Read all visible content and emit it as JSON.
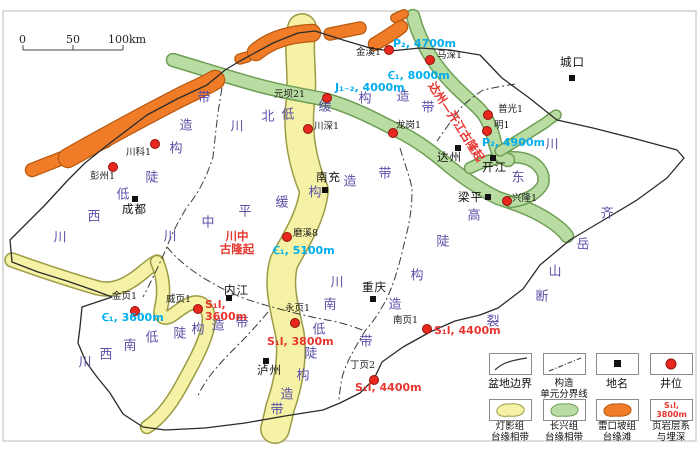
{
  "colors": {
    "cyan": "#00AEEF",
    "red": "#E8352E",
    "purple": "#5B50A8",
    "yellow_fill": "#f5f1a5",
    "yellow_edge": "#9b9b46",
    "green_fill": "#b9dca3",
    "green_edge": "#6f9e55",
    "orange_fill": "#f07c28",
    "orange_edge": "#b85a10",
    "well_dot": "#E8281E"
  },
  "scalebar": {
    "labels": [
      "0",
      "50",
      "100km"
    ]
  },
  "map": {
    "zone_phrases": [
      {
        "name": "chuanxi-low-steep-belt",
        "text": "川西低陡构造带",
        "chars": [
          [
            "川",
            60,
            238
          ],
          [
            "西",
            94,
            217
          ],
          [
            "低",
            123,
            195
          ],
          [
            "陡",
            152,
            178
          ],
          [
            "构",
            176,
            149
          ],
          [
            "造",
            186,
            126
          ],
          [
            "带",
            204,
            98
          ]
        ]
      },
      {
        "name": "chuanbei-low-gentle-belt",
        "text": "川北低缓构造带",
        "chars": [
          [
            "川",
            237,
            127
          ],
          [
            "北",
            268,
            117
          ],
          [
            "低",
            288,
            115
          ],
          [
            "缓",
            325,
            107
          ],
          [
            "构",
            365,
            99
          ],
          [
            "造",
            403,
            97
          ],
          [
            "带",
            428,
            108
          ]
        ]
      },
      {
        "name": "chuanzhong-flat-gentle-belt",
        "text": "川中平缓构造带",
        "chars": [
          [
            "川",
            170,
            237
          ],
          [
            "中",
            208,
            223
          ],
          [
            "平",
            245,
            212
          ],
          [
            "缓",
            282,
            203
          ],
          [
            "构",
            315,
            193
          ],
          [
            "造",
            350,
            182
          ],
          [
            "带",
            385,
            174
          ]
        ]
      },
      {
        "name": "chuandong-high-steep-belt",
        "text": "川东高陡构造带",
        "chars": [
          [
            "川",
            552,
            145
          ],
          [
            "东",
            518,
            178
          ],
          [
            "高",
            474,
            216
          ],
          [
            "陡",
            443,
            242
          ],
          [
            "构",
            417,
            276
          ],
          [
            "造",
            395,
            305
          ],
          [
            "带",
            366,
            342
          ]
        ]
      },
      {
        "name": "chuannan-low-steep-belt",
        "text": "川南低陡构造带",
        "chars": [
          [
            "川",
            337,
            283
          ],
          [
            "南",
            330,
            305
          ],
          [
            "低",
            319,
            330
          ],
          [
            "陡",
            311,
            354
          ],
          [
            "构",
            303,
            376
          ],
          [
            "造",
            287,
            395
          ],
          [
            "带",
            277,
            410
          ]
        ]
      },
      {
        "name": "chuanxinan-low-steep-belt",
        "text": "川西南低陡构造带",
        "chars": [
          [
            "川",
            85,
            363
          ],
          [
            "西",
            106,
            355
          ],
          [
            "南",
            130,
            346
          ],
          [
            "低",
            152,
            338
          ],
          [
            "陡",
            180,
            334
          ],
          [
            "构",
            198,
            330
          ],
          [
            "造",
            218,
            326
          ],
          [
            "带",
            242,
            323
          ]
        ]
      },
      {
        "name": "qiyueshan-fault",
        "text": "齐岳山断裂",
        "chars": [
          [
            "齐",
            607,
            214
          ],
          [
            "岳",
            583,
            245
          ],
          [
            "山",
            555,
            272
          ],
          [
            "断",
            542,
            297
          ],
          [
            "裂",
            493,
            322
          ]
        ]
      }
    ],
    "red_labels": [
      {
        "name": "chuanzhong-paleo-uplift",
        "lines": [
          "川中",
          "古隆起"
        ],
        "x": 237,
        "y": 243,
        "rotate": 0
      },
      {
        "name": "dazhou-kaijiang-paleo-uplift",
        "lines": [
          "达州—开江古隆起"
        ],
        "x": 456,
        "y": 122,
        "rotate": 57
      }
    ],
    "cities": [
      {
        "name": "城口",
        "sx": 572,
        "sy": 78,
        "lx": 560,
        "ly": 56
      },
      {
        "name": "成都",
        "sx": 135,
        "sy": 199,
        "lx": 122,
        "ly": 203
      },
      {
        "name": "南充",
        "sx": 325,
        "sy": 190,
        "lx": 316,
        "ly": 171
      },
      {
        "name": "达州",
        "sx": 458,
        "sy": 148,
        "lx": 437,
        "ly": 151
      },
      {
        "name": "开江",
        "sx": 493,
        "sy": 158,
        "lx": 482,
        "ly": 161
      },
      {
        "name": "梁平",
        "sx": 488,
        "sy": 197,
        "lx": 458,
        "ly": 191
      },
      {
        "name": "内江",
        "sx": 229,
        "sy": 298,
        "lx": 224,
        "ly": 284
      },
      {
        "name": "泸州",
        "sx": 266,
        "sy": 361,
        "lx": 257,
        "ly": 364
      },
      {
        "name": "重庆",
        "sx": 373,
        "sy": 299,
        "lx": 362,
        "ly": 281
      }
    ],
    "wells": [
      {
        "name": "川科1",
        "x": 155,
        "y": 144,
        "lx": 126,
        "ly": 148
      },
      {
        "name": "彭州1",
        "x": 113,
        "y": 167,
        "lx": 90,
        "ly": 172
      },
      {
        "name": "金溪1",
        "x": 389,
        "y": 50,
        "lx": 356,
        "ly": 48
      },
      {
        "name": "马深1",
        "x": 430,
        "y": 60,
        "lx": 437,
        "ly": 51
      },
      {
        "name": "元坝21",
        "x": 327,
        "y": 98,
        "lx": 274,
        "ly": 90
      },
      {
        "name": "川深1",
        "x": 308,
        "y": 129,
        "lx": 314,
        "ly": 122
      },
      {
        "name": "龙岗1",
        "x": 393,
        "y": 133,
        "lx": 396,
        "ly": 121
      },
      {
        "name": "普光1",
        "x": 488,
        "y": 115,
        "lx": 498,
        "ly": 105
      },
      {
        "name": "明1",
        "x": 487,
        "y": 131,
        "lx": 494,
        "ly": 121
      },
      {
        "name": "兴隆1",
        "x": 507,
        "y": 201,
        "lx": 512,
        "ly": 194
      },
      {
        "name": "磨溪8",
        "x": 287,
        "y": 237,
        "lx": 293,
        "ly": 229
      },
      {
        "name": "金页1",
        "x": 135,
        "y": 311,
        "lx": 112,
        "ly": 292
      },
      {
        "name": "威页1",
        "x": 198,
        "y": 309,
        "lx": 166,
        "ly": 295
      },
      {
        "name": "永页1",
        "x": 295,
        "y": 323,
        "lx": 285,
        "ly": 304
      },
      {
        "name": "南页1",
        "x": 427,
        "y": 329,
        "lx": 393,
        "ly": 316
      },
      {
        "name": "丁页2",
        "x": 374,
        "y": 380,
        "lx": 350,
        "ly": 361
      }
    ],
    "depth_labels": [
      {
        "lines": [
          "P₂, 4700m"
        ],
        "x": 393,
        "y": 38,
        "color": "cyan"
      },
      {
        "lines": [
          "Ꞓ₁, 8000m"
        ],
        "x": 388,
        "y": 70,
        "color": "cyan"
      },
      {
        "lines": [
          "J₁₋₂, 4000m"
        ],
        "x": 335,
        "y": 82,
        "color": "cyan"
      },
      {
        "lines": [
          "P₂, 4900m"
        ],
        "x": 482,
        "y": 137,
        "color": "cyan"
      },
      {
        "lines": [
          "Ꞓ₁, 5100m"
        ],
        "x": 273,
        "y": 245,
        "color": "cyan"
      },
      {
        "lines": [
          "Ꞓ₁, 3600m"
        ],
        "x": 102,
        "y": 312,
        "color": "cyan"
      },
      {
        "lines": [
          "S₁l,",
          "3600m"
        ],
        "x": 205,
        "y": 299,
        "color": "red"
      },
      {
        "lines": [
          "S₁l, 3800m"
        ],
        "x": 267,
        "y": 336,
        "color": "red"
      },
      {
        "lines": [
          "S₁l, 4400m"
        ],
        "x": 434,
        "y": 325,
        "color": "red"
      },
      {
        "lines": [
          "S₁l, 4400m"
        ],
        "x": 355,
        "y": 382,
        "color": "red"
      }
    ]
  },
  "legend": {
    "cols_x": [
      489,
      543,
      596,
      650
    ],
    "row_box_y": [
      353,
      399
    ],
    "row_label_y": [
      378,
      421
    ],
    "row1": [
      {
        "name": "basin-boundary",
        "symbol": "curve",
        "label_lines": [
          "盆地边界"
        ]
      },
      {
        "name": "unit-boundary",
        "symbol": "dashdot",
        "label_lines": [
          "构造",
          "单元分界线"
        ]
      },
      {
        "name": "place-name",
        "symbol": "square",
        "label_lines": [
          "地名"
        ]
      },
      {
        "name": "well-location",
        "symbol": "dot",
        "label_lines": [
          "井位"
        ]
      }
    ],
    "row2": [
      {
        "name": "dengying-platform-margin",
        "symbol": "yellow-blob",
        "label_lines": [
          "灯影组",
          "台缘相带"
        ]
      },
      {
        "name": "changxing-platform-margin",
        "symbol": "green-blob",
        "label_lines": [
          "长兴组",
          "台缘相带"
        ]
      },
      {
        "name": "leikoupo-margin-shoal",
        "symbol": "orange-blob",
        "label_lines": [
          "雷口坡组",
          "台缘滩"
        ]
      },
      {
        "name": "shale-series-depth",
        "symbol": "shale-text",
        "symbol_lines": [
          "S₁l,",
          "3800m"
        ],
        "label_lines": [
          "页岩层系",
          "与埋深"
        ]
      }
    ]
  }
}
